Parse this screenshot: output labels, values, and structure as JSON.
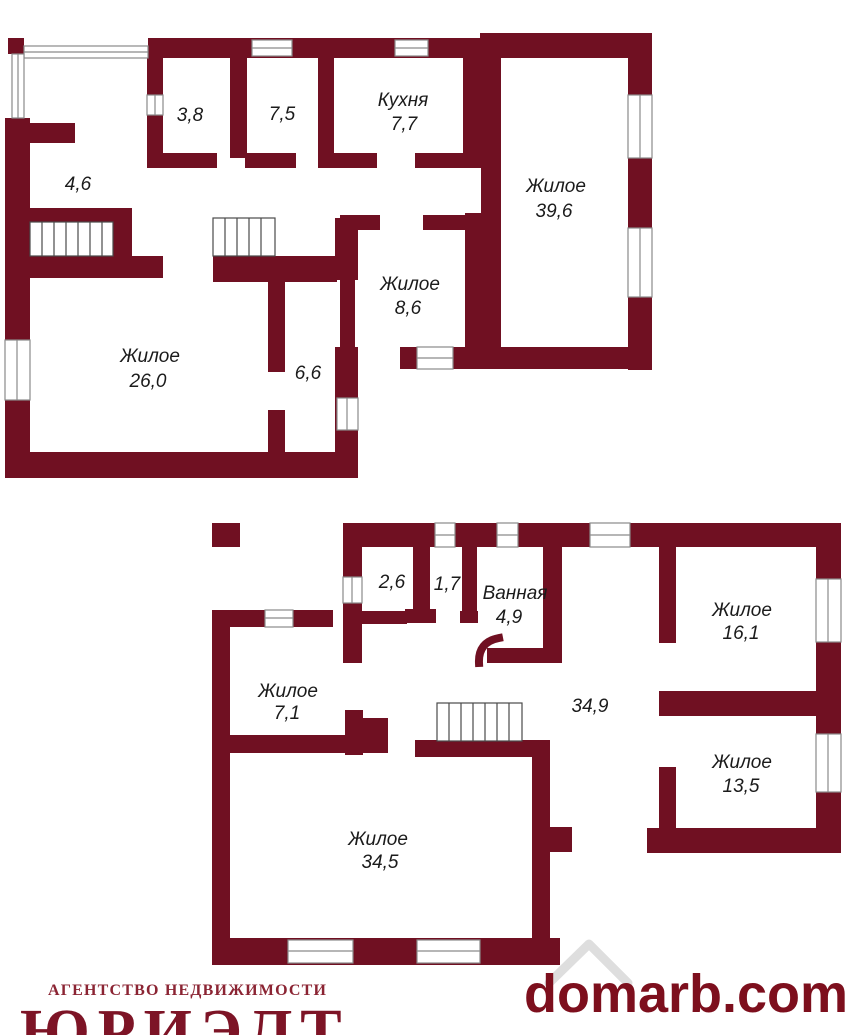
{
  "colors": {
    "wall": "#701022",
    "label_text": "#1b1b1b",
    "agency_name_color": "#7d1426",
    "agency_caption_color": "#8b2433",
    "watermark_color": "#7d0f1d"
  },
  "footer": {
    "agency_caption": "АГЕНТСТВО НЕДВИЖИМОСТИ",
    "agency_name": "ЮРИЭЛТ",
    "watermark": "domarb.com"
  },
  "floors": [
    {
      "id": "upper-plan",
      "rooms": [
        {
          "name": "",
          "area": "3,8"
        },
        {
          "name": "",
          "area": "7,5"
        },
        {
          "name": "Кухня",
          "area": "7,7"
        },
        {
          "name": "Жилое",
          "area": "39,6"
        },
        {
          "name": "",
          "area": "4,6"
        },
        {
          "name": "Жилое",
          "area": "8,6"
        },
        {
          "name": "Жилое",
          "area": "26,0"
        },
        {
          "name": "",
          "area": "6,6"
        }
      ]
    },
    {
      "id": "lower-plan",
      "rooms": [
        {
          "name": "",
          "area": "2,6"
        },
        {
          "name": "",
          "area": "1,7"
        },
        {
          "name": "Ванная",
          "area": "4,9"
        },
        {
          "name": "Жилое",
          "area": "16,1"
        },
        {
          "name": "",
          "area": "34,9"
        },
        {
          "name": "Жилое",
          "area": "7,1"
        },
        {
          "name": "Жилое",
          "area": "13,5"
        },
        {
          "name": "Жилое",
          "area": "34,5"
        }
      ]
    }
  ]
}
